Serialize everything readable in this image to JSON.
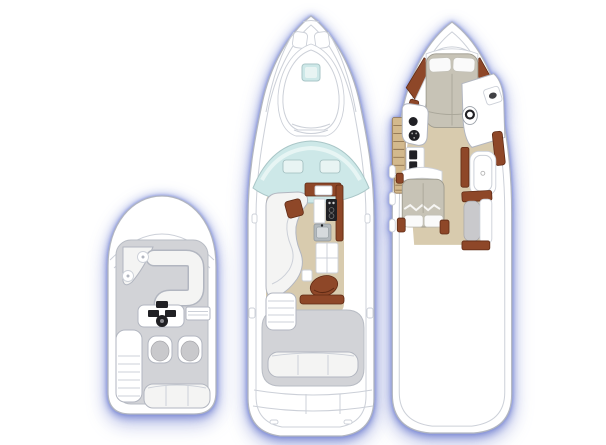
{
  "figure": {
    "description": "yacht-three-deck-floor-plans",
    "plans": [
      {
        "id": "flybridge",
        "label": "flybridge-deck-plan"
      },
      {
        "id": "main-deck",
        "label": "main-deck-plan"
      },
      {
        "id": "lower-deck",
        "label": "lower-accommodation-deck-plan"
      }
    ]
  },
  "colors": {
    "page_bg": "#ffffff",
    "hull_fill": "#ffffff",
    "hull_line": "#b2b6c0",
    "line_soft": "#ccd0d8",
    "deck_floor": "#d2d3d7",
    "deck_floor_line": "#b8bcc4",
    "interior_floor": "#d8cbae",
    "wood": "#8e4728",
    "wood_dark": "#5f2a14",
    "cushion": "#f4f4f3",
    "seat_gray": "#c9c9cc",
    "mattress": "#c7c3b6",
    "glass": "#cde8e8",
    "glass_light": "#e8f4f3",
    "dark_detail": "#202024",
    "metal": "#b3b9bd",
    "steps_tan": "#d3b98d",
    "steps_rung": "#8f7350",
    "glow": "#6d84cf"
  }
}
